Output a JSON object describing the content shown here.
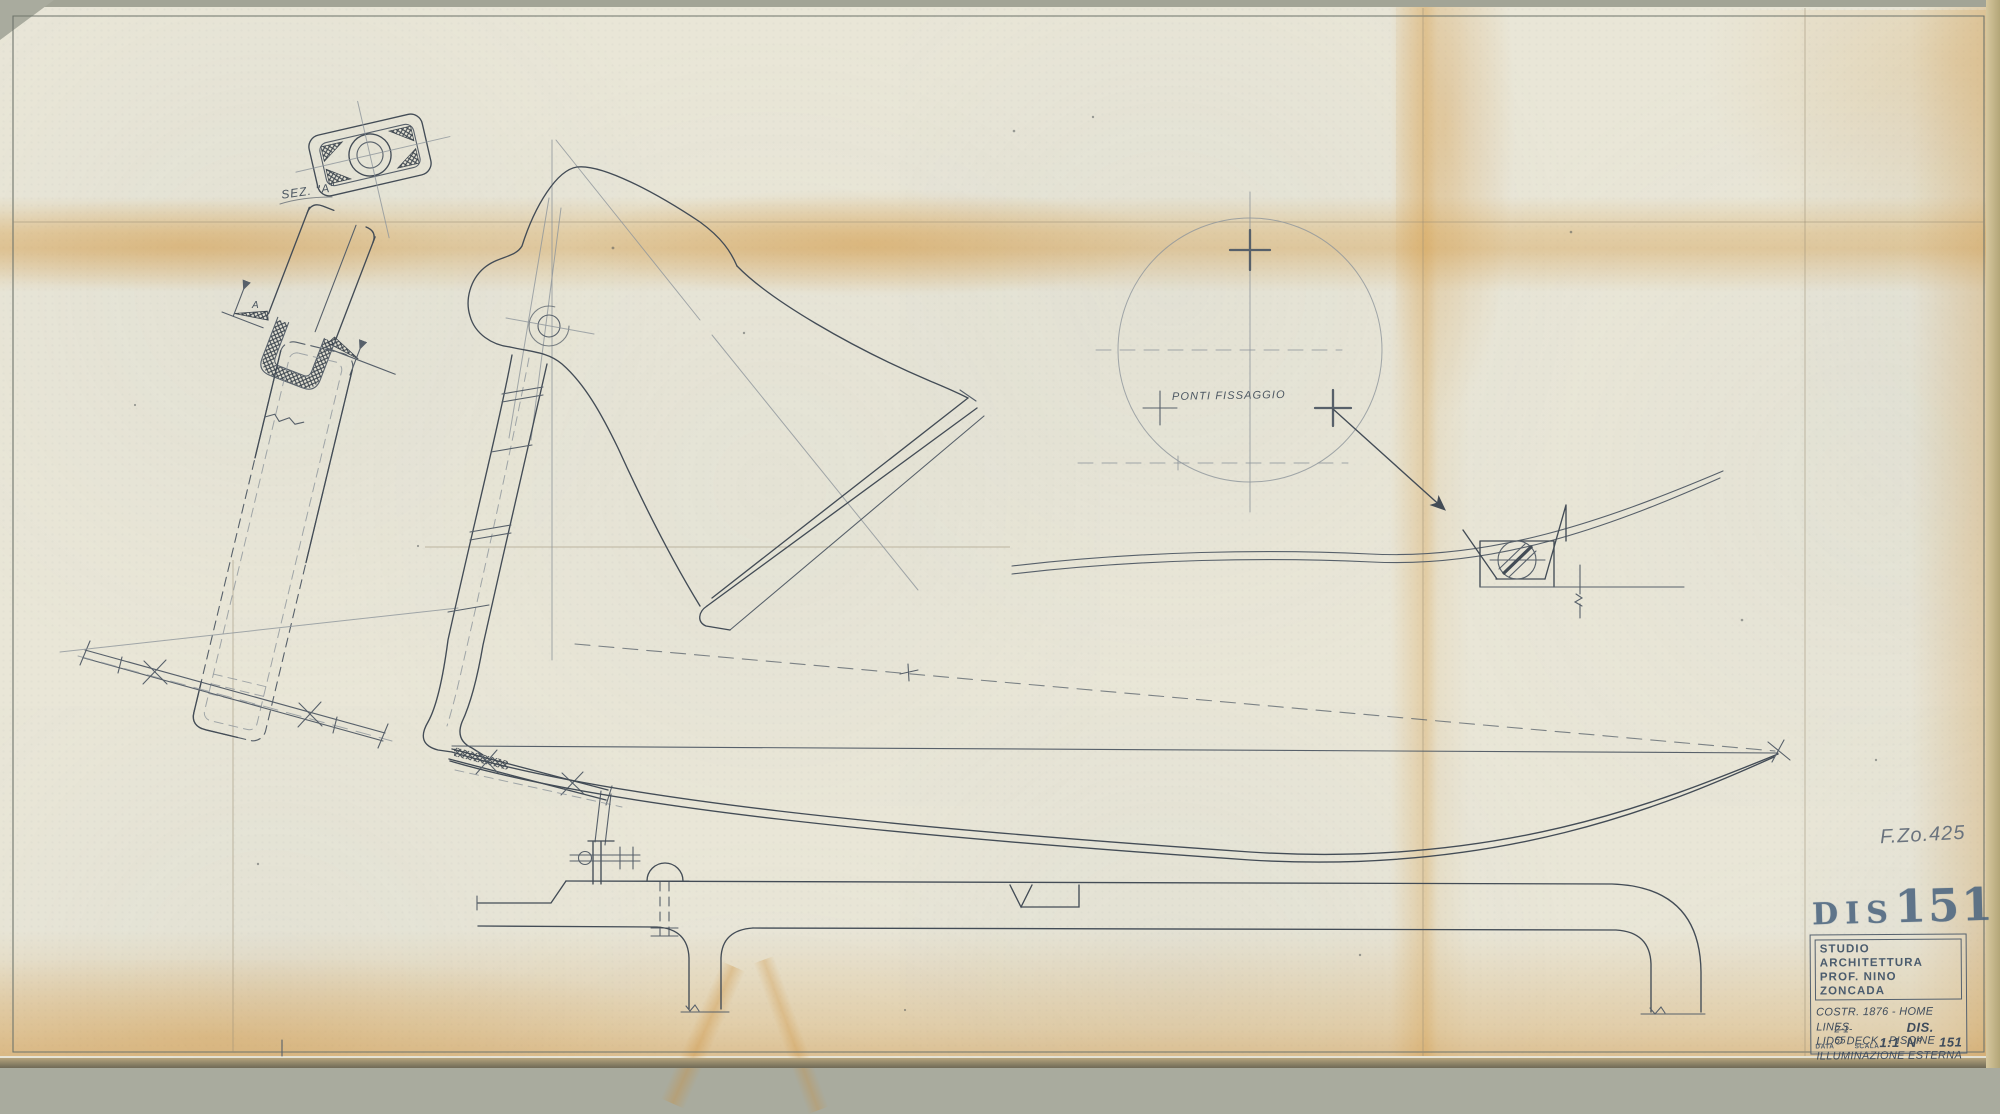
{
  "drawing": {
    "labels": {
      "section": "SEZ. \"A\"",
      "section_arrow": "A",
      "fixing_points": "PONTI FISSAGGIO",
      "file_ref": "F.Zo.425"
    },
    "stamp": {
      "prefix": "DIS",
      "number": "151"
    },
    "title_block": {
      "studio_line1": "STUDIO ARCHITETTURA",
      "studio_line2": "PROF. NINO ZONCADA",
      "project_line1": "COSTR. 1876 - HOME LINES",
      "project_line2": "LIDO DECK -  PISCINE",
      "project_line3": "ILLUMINAZIONE ESTERNA",
      "data_label": "DATA",
      "data_value": "2-1-65",
      "scala_label": "SCALA",
      "scala_value": "1:1",
      "dis_label": "DIS. N°",
      "dis_value": "151"
    },
    "colors": {
      "paper": "#e9e6d7",
      "stain_amber": "#d89c42",
      "pencil": "#49525a",
      "stamp_ink": "#4d6680"
    }
  }
}
